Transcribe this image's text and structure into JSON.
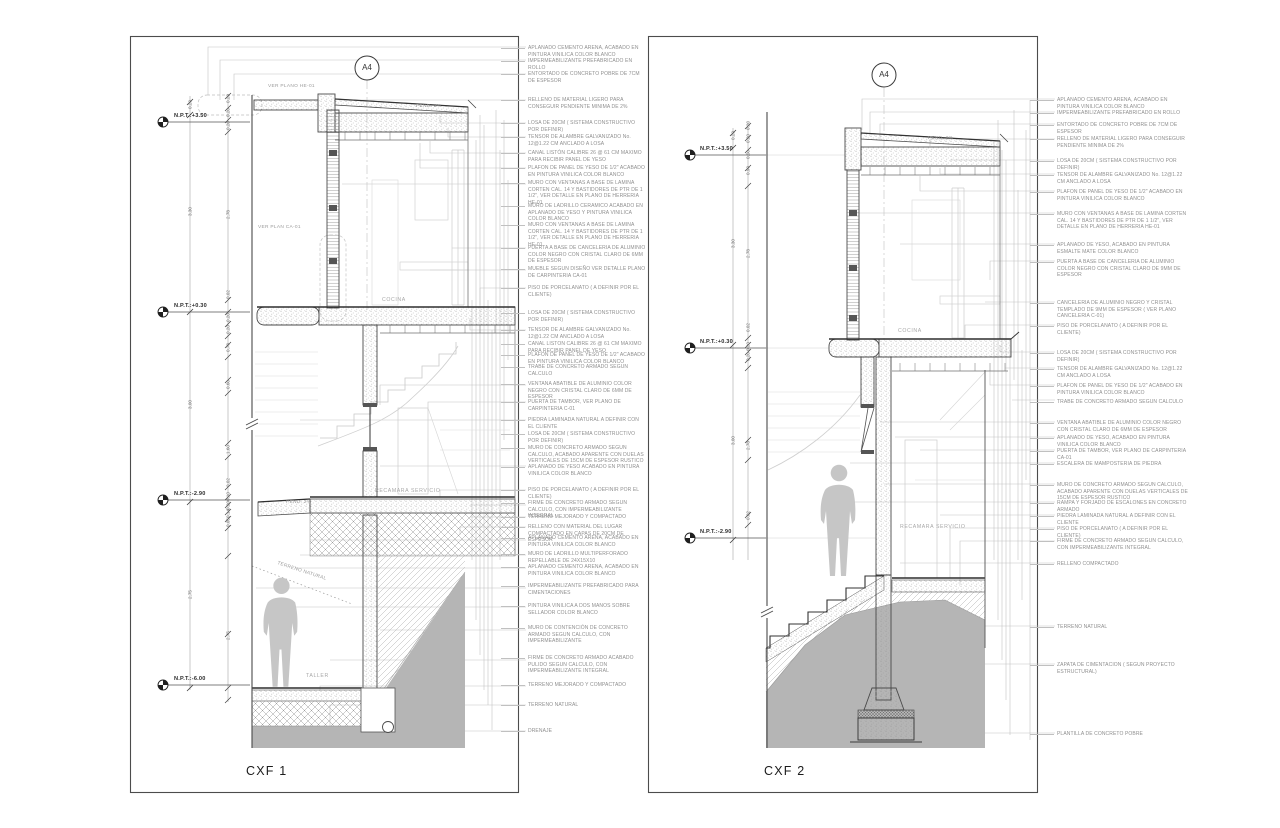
{
  "s1": {
    "title": "CXF 1",
    "marker": "A4",
    "levels": [
      "N.P.T.:+3.50",
      "N.P.T.:+0.30",
      "N.P.T.:-2.90",
      "N.P.T.:-6.00"
    ],
    "rooms": {
      "cocina": "COCINA",
      "recamara": "RECAMARA SERVICIO",
      "taller": "TALLER"
    },
    "labels": {
      "ver_he": "VER PLANO HE-01",
      "ver_ca": "VER PLAN CA-01",
      "pend_roof": "PEND. 2%",
      "pend_floor": "PEND. 2%",
      "terreno": "TERRENO NATURAL"
    },
    "dims": [
      "0.20",
      "3.30",
      "3.00",
      "2.75",
      "0.20",
      "0.20",
      "0.20",
      "2.78",
      "0.02",
      "0.20",
      "0.20",
      "0.78",
      "0.60",
      "1.60",
      "0.02",
      "0.10",
      "0.20",
      "0.14",
      "0.05",
      "2.75"
    ],
    "notes": [
      "APLANADO CEMENTO ARENA, ACABADO EN PINTURA VINILICA COLOR BLANCO",
      "IMPERMEABILIZANTE PREFABRICADO EN ROLLO",
      "ENTORTADO DE CONCRETO POBRE DE 7CM DE ESPESOR",
      "RELLENO DE MATERIAL LIGERO PARA CONSEGUIR PENDIENTE MINIMA DE 2%",
      "LOSA DE 20CM ( SISTEMA CONSTRUCTIVO POR DEFINIR)",
      "TENSOR DE ALAMBRE GALVANIZADO No. 12@1.22 CM ANCLADO A LOSA",
      "CANAL LISTÓN CALIBRE 26 @ 61 CM MAXIMO PARA RECIBIR PANEL DE YESO",
      "PLAFON DE PANEL DE YESO DE 1/2\" ACABADO EN PINTURA VINILICA COLOR BLANCO",
      "MURO CON VENTANAS A BASE DE LAMINA CORTEN CAL. 14 Y BASTIDORES DE PTR DE 1 1/2\", VER DETALLE EN PLANO DE HERRERIA HE-01",
      "MURO DE LADRILLO CERAMICO ACABADO EN APLANADO DE YESO Y PINTURA VINILICA COLOR BLANCO",
      "MURO CON VENTANAS A BASE DE LAMINA CORTEN CAL. 14 Y BASTIDORES DE PTR DE 1 1/2\", VER DETALLE EN PLANO DE HERRERIA HE-01",
      "PUERTA A BASE DE CANCELERIA DE ALUMINIO COLOR NEGRO CON CRISTAL CLARO DE 6MM DE ESPESOR",
      "MUEBLE SEGUN DISEÑO VER DETALLE PLANO DE CARPINTERIA CA-01",
      "PISO DE PORCELANATO ( A DEFINIR POR EL CLIENTE)",
      "LOSA DE 20CM ( SISTEMA CONSTRUCTIVO POR DEFINIR)",
      "TENSOR DE ALAMBRE GALVANIZADO No. 12@1.22 CM ANCLADO A LOSA",
      "CANAL LISTON CALIBRE 26 @ 61 CM MAXIMO PARA RECIBIR PANEL DE YESO",
      "PLAFON DE PANEL DE YESO DE 1/2\" ACABADO EN PINTURA VINILICA COLOR BLANCO",
      "TRABE DE CONCRETO ARMADO SEGUN CALCULO",
      "VENTANA ABATIBLE DE ALUMINIO COLOR NEGRO CON CRISTAL CLARO DE 6MM DE ESPESOR",
      "PUERTA DE TAMBOR, VER PLANO DE CARPINTERIA C-01",
      "PIEDRA LAMINADA NATURAL A DEFINIR CON EL CLIENTE",
      "LOSA DE 20CM ( SISTEMA CONSTRUCTIVO POR DEFINIR)",
      "MURO DE CONCRETO ARMADO SEGUN CALCULO, ACABADO APARENTE CON DUELAS VERTICALES DE 15CM DE ESPESOR RUSTICO",
      "APLANADO DE YESO ACABADO EN PINTURA VINILICA COLOR BLANCO",
      "PISO DE PORCELANATO ( A DEFINIR POR EL CLIENTE)",
      "FIRME DE CONCRETO ARMADO SEGUN CALCULO, CON IMPERMEABILIZANTE INTEGRAL",
      "TERRENO MEJORADO Y COMPACTADO",
      "RELLENO CON MATERIAL DEL LUGAR COMPACTADO EN CAPAS DE 20CM DE ESPESOR",
      "APLANADO CEMENTO ARENA, ACABADO EN PINTURA VINILICA COLOR BLANCO",
      "MURO DE LADRILLO MULTIPERFORADO REPELLABLE DE 24X15X10",
      "APLANADO CEMENTO ARENA, ACABADO EN PINTURA VINILICA COLOR BLANCO",
      "IMPERMEABILIZANTE PREFABRICADO PARA CIMENTACIONES",
      "PINTURA VINILICA A DOS MANOS SOBRE SELLADOR COLOR BLANCO",
      "MURO DE CONTENCIÓN DE CONCRETO ARMADO SEGUN CALCULO, CON IMPERMEABILIZANTE",
      "FIRME DE CONCRETO ARMADO ACABADO PULIDO SEGUN CALCULO, CON IMPERMEABILIZANTE INTEGRAL",
      "TERRENO MEJORADO Y COMPACTADO",
      "TERRENO NATURAL",
      "DRENAJE"
    ]
  },
  "s2": {
    "title": "CXF 2",
    "marker": "A4",
    "levels": [
      "N.P.T.:+3.50",
      "N.P.T.:+0.30",
      "N.P.T.:-2.90"
    ],
    "rooms": {
      "cocina": "COCINA",
      "recamara": "RECAMARA SERVICIO"
    },
    "labels": {
      "pend_roof": "PEND. 2%"
    },
    "dims": [
      "0.20",
      "3.30",
      "3.00",
      "0.20",
      "0.20",
      "0.50",
      "0.90",
      "2.78",
      "0.02",
      "0.20",
      "0.20",
      "2.78",
      "0.02"
    ],
    "notes": [
      "APLANADO CEMENTO ARENA, ACABADO EN PINTURA VINILICA COLOR BLANCO",
      "IMPERMEABILIZANTE PREFABRICADO EN ROLLO",
      "ENTORTADO DE CONCRETO POBRE DE 7CM DE ESPESOR",
      "RELLENO DE MATERIAL LIGERO PARA CONSEGUIR PENDIENTE MINIMA DE 2%",
      "LOSA DE 20CM ( SISTEMA CONSTRUCTIVO POR DEFINIR)",
      "TENSOR DE ALAMBRE GALVANIZADO No. 12@1.22 CM ANCLADO A LOSA",
      "PLAFON DE PANEL DE YESO DE 1/2\" ACABADO EN PINTURA VINILICA COLOR BLANCO",
      "MURO CON VENTANAS A BASE DE LAMINA CORTEN CAL. 14 Y BASTIDORES DE PTR DE 1 1/2\", VER DETALLE EN PLANO DE HERRERIA HE-01",
      "APLANADO DE YESO, ACABADO EN PINTURA ESMALTE MATE COLOR BLANCO",
      "PUERTA A BASE DE CANCELERIA DE ALUMINIO COLOR NEGRO CON CRISTAL CLARO DE 9MM DE ESPESOR",
      "CANCELERIA DE ALUMINIO NEGRO Y CRISTAL TEMPLADO DE 9MM DE ESPESOR ( VER PLANO CANCELERIA C-01)",
      "PISO DE PORCELANATO ( A DEFINIR POR EL CLIENTE)",
      "LOSA DE 20CM ( SISTEMA CONSTRUCTIVO POR DEFINIR)",
      "TENSOR DE ALAMBRE GALVANIZADO No. 12@1.22 CM ANCLADO A LOSA",
      "PLAFON DE PANEL DE YESO DE 1/2\" ACABADO EN PINTURA VINILICA COLOR BLANCO",
      "TRABE DE CONCRETO ARMADO SEGUN CALCULO",
      "VENTANA ABATIBLE DE ALUMINIO COLOR NEGRO CON CRISTAL CLARO DE 6MM DE ESPESOR",
      "APLANADO DE YESO, ACABADO EN PINTURA VINILICA COLOR BLANCO",
      "PUERTA DE TAMBOR, VER PLANO DE CARPINTERIA CA-01",
      "ESCALERA DE MAMPOSTERIA DE PIEDRA",
      "MURO DE CONCRETO ARMADO SEGUN CALCULO, ACABADO APARENTE CON DUELAS VERTICALES DE 15CM DE ESPESOR RUSTICO",
      "RAMPA Y FORJADO DE ESCALONES EN CONCRETO ARMADO",
      "PIEDRA LAMINADA NATURAL A DEFINIR CON EL CLIENTE",
      "PISO DE PORCELANATO ( A DEFINIR POR EL CLIENTE)",
      "FIRME DE CONCRETO ARMADO SEGUN CALCULO, CON IMPERMEABILIZANTE INTEGRAL",
      "RELLENO COMPACTADO",
      "TERRENO NATURAL",
      "ZAPATA DE CIMENTACION ( SEGUN PROYECTO ESTRUCTURAL)",
      "PLANTILLA DE CONCRETO POBRE"
    ]
  },
  "colors": {
    "paper": "#ffffff",
    "line_dark": "#3f3f3f",
    "line_light": "#c6c6c6",
    "terrain": "#b5b5b5",
    "note_text": "#8f8f8f"
  }
}
